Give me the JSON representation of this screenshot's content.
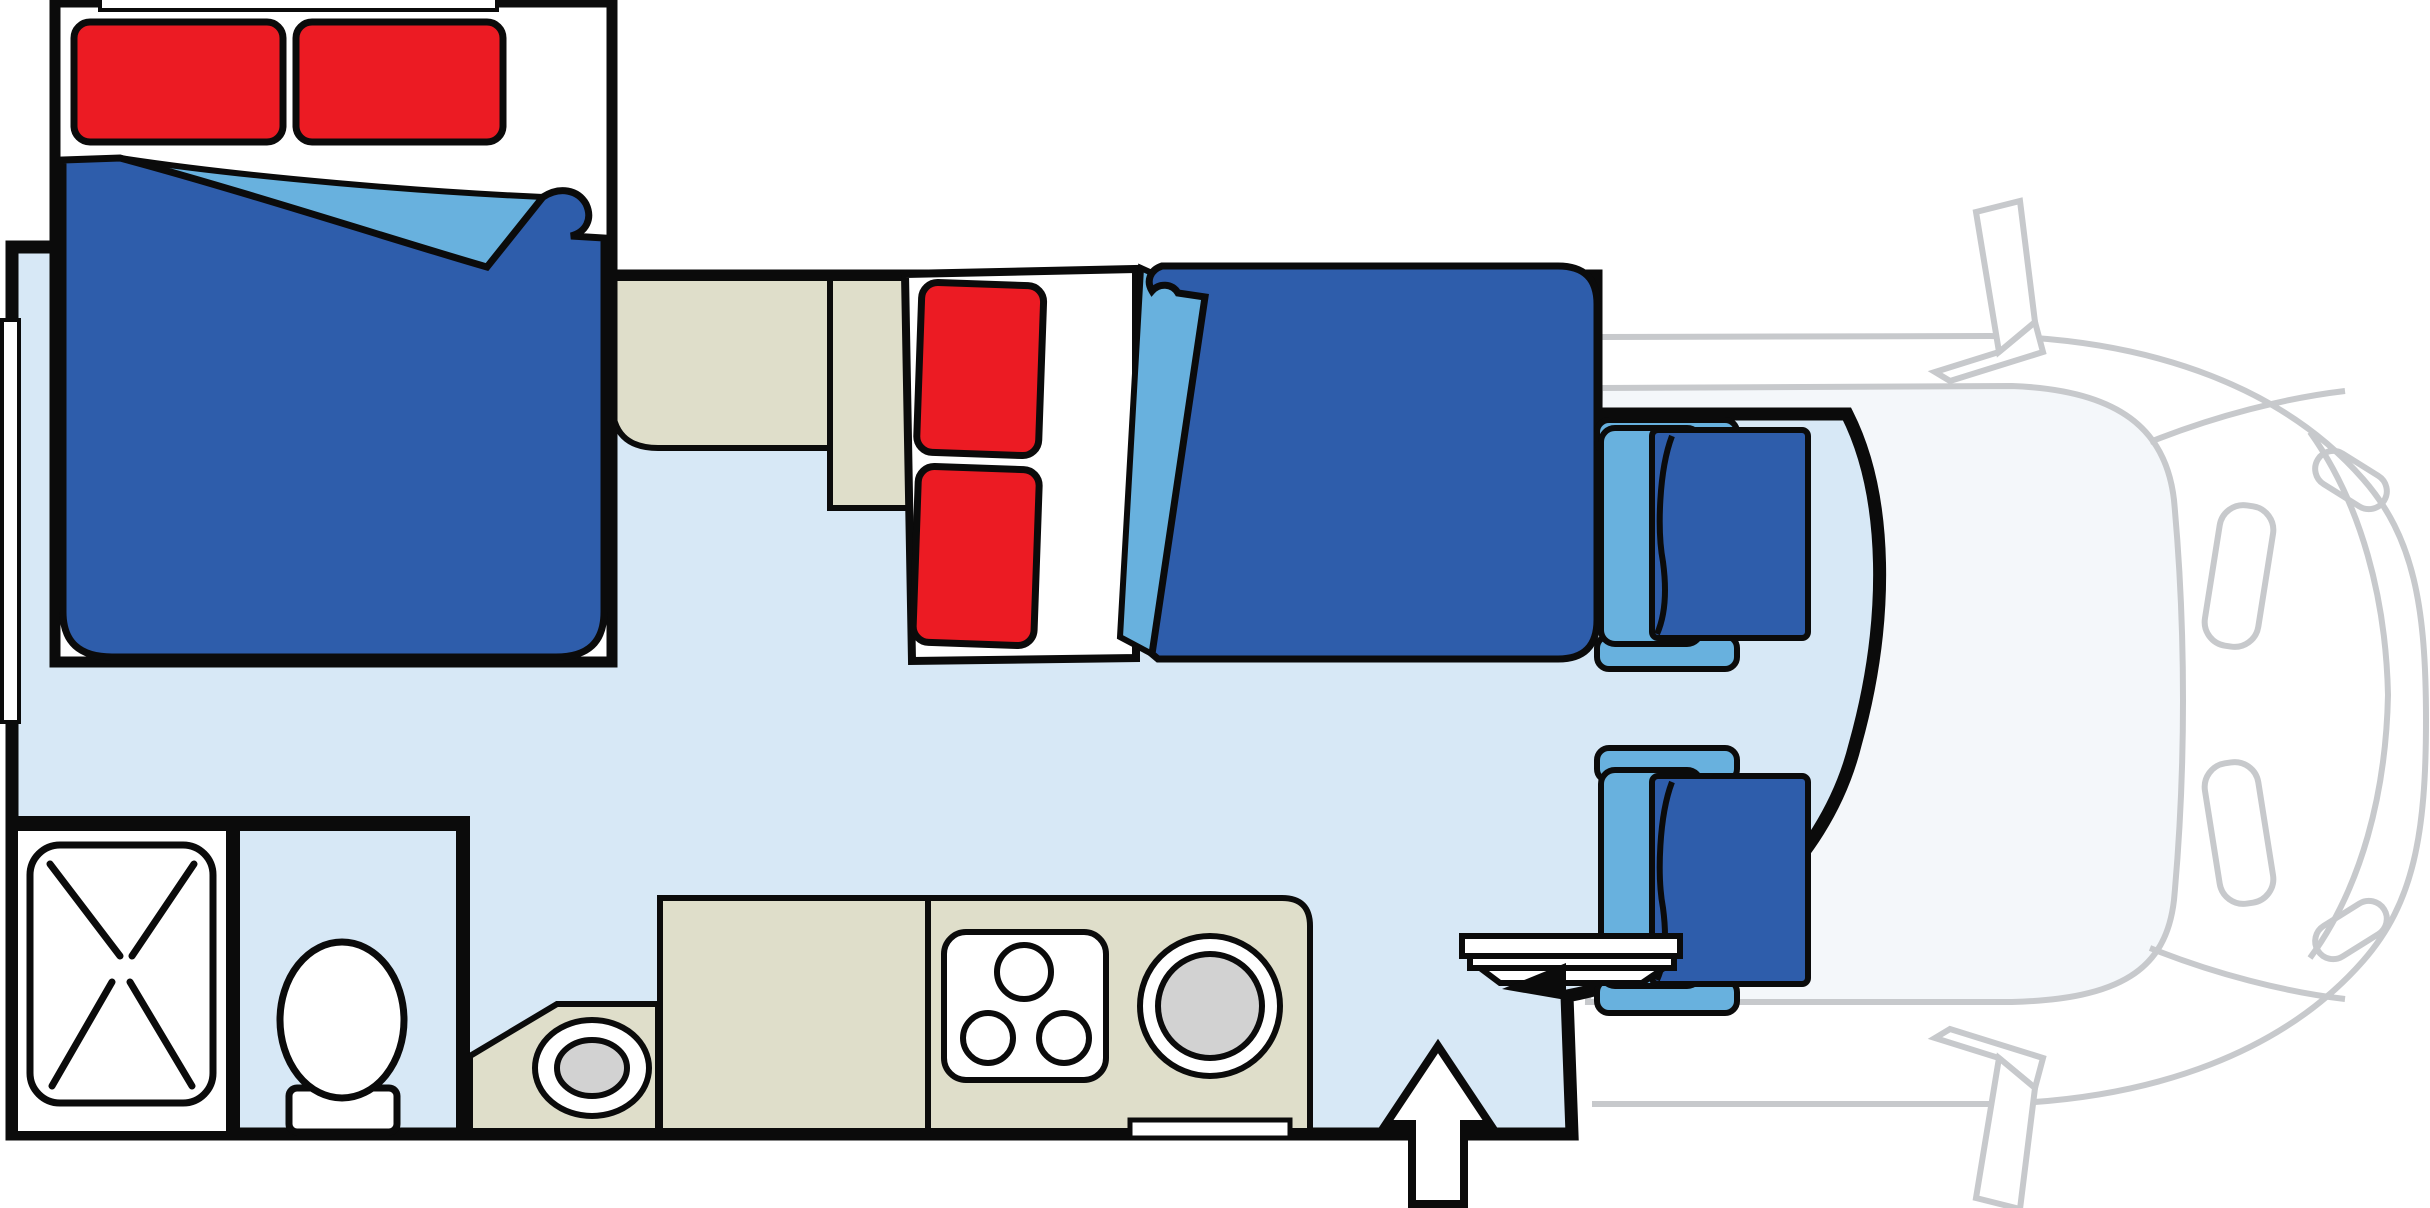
{
  "page": {
    "background": "#ffffff",
    "description": "Motorhome (cab-over camper) floor plan, top view, no text labels"
  },
  "palette": {
    "background": "#ffffff",
    "wall": "#0b0b0b",
    "floor": "#d7e8f6",
    "bedding_navy": "#2e5dab",
    "bedding_lightblue": "#68b1de",
    "pillow_red": "#ec1b23",
    "cabinet_beige": "#dfdeca",
    "fixture_white": "#ffffff",
    "sink_gray": "#d2d2d2",
    "cab_gray": "#c7c9cc",
    "cab_interior": "#f4f7fa"
  },
  "floorplan": {
    "vehicle": "motorhome-top-view",
    "areas": [
      {
        "name": "cab-over-double-bed",
        "features": [
          "two red pillows",
          "navy duvet with folded light-blue corner",
          "rear window strip"
        ]
      },
      {
        "name": "single-bed-dinette",
        "features": [
          "two red pillows",
          "navy duvet with folded light-blue corner",
          "white head panel"
        ]
      },
      {
        "name": "overhead-cabinets",
        "features": [
          "two beige storage blocks"
        ]
      },
      {
        "name": "kitchen",
        "features": [
          "beige counter",
          "three-burner stove",
          "round sink",
          "oval corner basin"
        ]
      },
      {
        "name": "bathroom",
        "features": [
          "shower tray with cross pattern",
          "toilet"
        ]
      },
      {
        "name": "cockpit",
        "features": [
          "driver seat swiveled",
          "passenger seat swiveled",
          "pedestal table",
          "entry arrow"
        ]
      },
      {
        "name": "truck-cab",
        "features": [
          "gray outline of cab, hood, windshield, mirrors, headlights"
        ]
      }
    ]
  }
}
